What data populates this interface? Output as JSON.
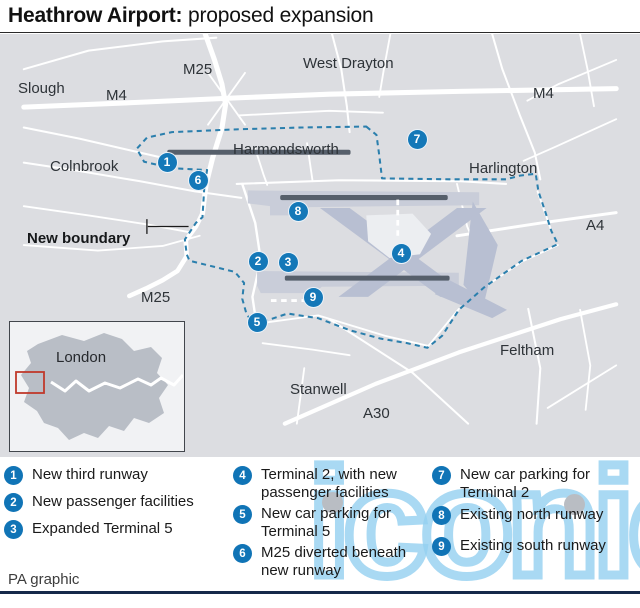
{
  "title": {
    "bold": "Heathrow Airport:",
    "regular": " proposed expansion"
  },
  "map": {
    "labels": [
      {
        "text": "Slough",
        "x": 18,
        "y": 80
      },
      {
        "text": "M4",
        "x": 106,
        "y": 87
      },
      {
        "text": "M25",
        "x": 183,
        "y": 61
      },
      {
        "text": "West Drayton",
        "x": 303,
        "y": 55
      },
      {
        "text": "M4",
        "x": 533,
        "y": 85
      },
      {
        "text": "Harmondsworth",
        "x": 233,
        "y": 141
      },
      {
        "text": "Colnbrook",
        "x": 50,
        "y": 158
      },
      {
        "text": "Harlington",
        "x": 469,
        "y": 160
      },
      {
        "text": "A4",
        "x": 586,
        "y": 217
      },
      {
        "text": "New boundary",
        "x": 27,
        "y": 230,
        "bold": true
      },
      {
        "text": "M25",
        "x": 141,
        "y": 289
      },
      {
        "text": "Feltham",
        "x": 500,
        "y": 342
      },
      {
        "text": "Stanwell",
        "x": 290,
        "y": 381
      },
      {
        "text": "A30",
        "x": 363,
        "y": 405
      }
    ],
    "markers": [
      {
        "n": "1",
        "x": 167,
        "y": 162
      },
      {
        "n": "2",
        "x": 258,
        "y": 261
      },
      {
        "n": "3",
        "x": 288,
        "y": 262
      },
      {
        "n": "4",
        "x": 401,
        "y": 253
      },
      {
        "n": "5",
        "x": 257,
        "y": 322
      },
      {
        "n": "6",
        "x": 198,
        "y": 180
      },
      {
        "n": "7",
        "x": 417,
        "y": 139
      },
      {
        "n": "8",
        "x": 298,
        "y": 211
      },
      {
        "n": "9",
        "x": 313,
        "y": 297
      }
    ],
    "inset": {
      "label": "London"
    }
  },
  "legend": {
    "columns": [
      [
        {
          "n": "1",
          "label": "New third runway"
        },
        {
          "n": "2",
          "label": "New passenger facilities"
        },
        {
          "n": "3",
          "label": "Expanded Terminal 5"
        }
      ],
      [
        {
          "n": "4",
          "label": "Terminal 2, with new passenger facilities"
        },
        {
          "n": "5",
          "label": "New car parking for Terminal 5"
        },
        {
          "n": "6",
          "label": "M25 diverted beneath new runway"
        }
      ],
      [
        {
          "n": "7",
          "label": "New car parking for Terminal 2"
        },
        {
          "n": "8",
          "label": "Existing north runway"
        },
        {
          "n": "9",
          "label": "Existing south runway"
        }
      ]
    ]
  },
  "footer": {
    "credit": "PA graphic"
  },
  "watermark": {
    "text": "iconic"
  },
  "colors": {
    "marker_blue": "#1478b8",
    "legend_blue": "#1074b6",
    "boundary_blue": "#2b7fad",
    "runway_dark": "#565f6b",
    "map_bg": "#dcdde1",
    "airport_apron": "#c9cdd9",
    "airport_bands": "#b8bfd2",
    "watermark_blue": "#93d0f0",
    "inset_red_box": "#c0392b"
  }
}
